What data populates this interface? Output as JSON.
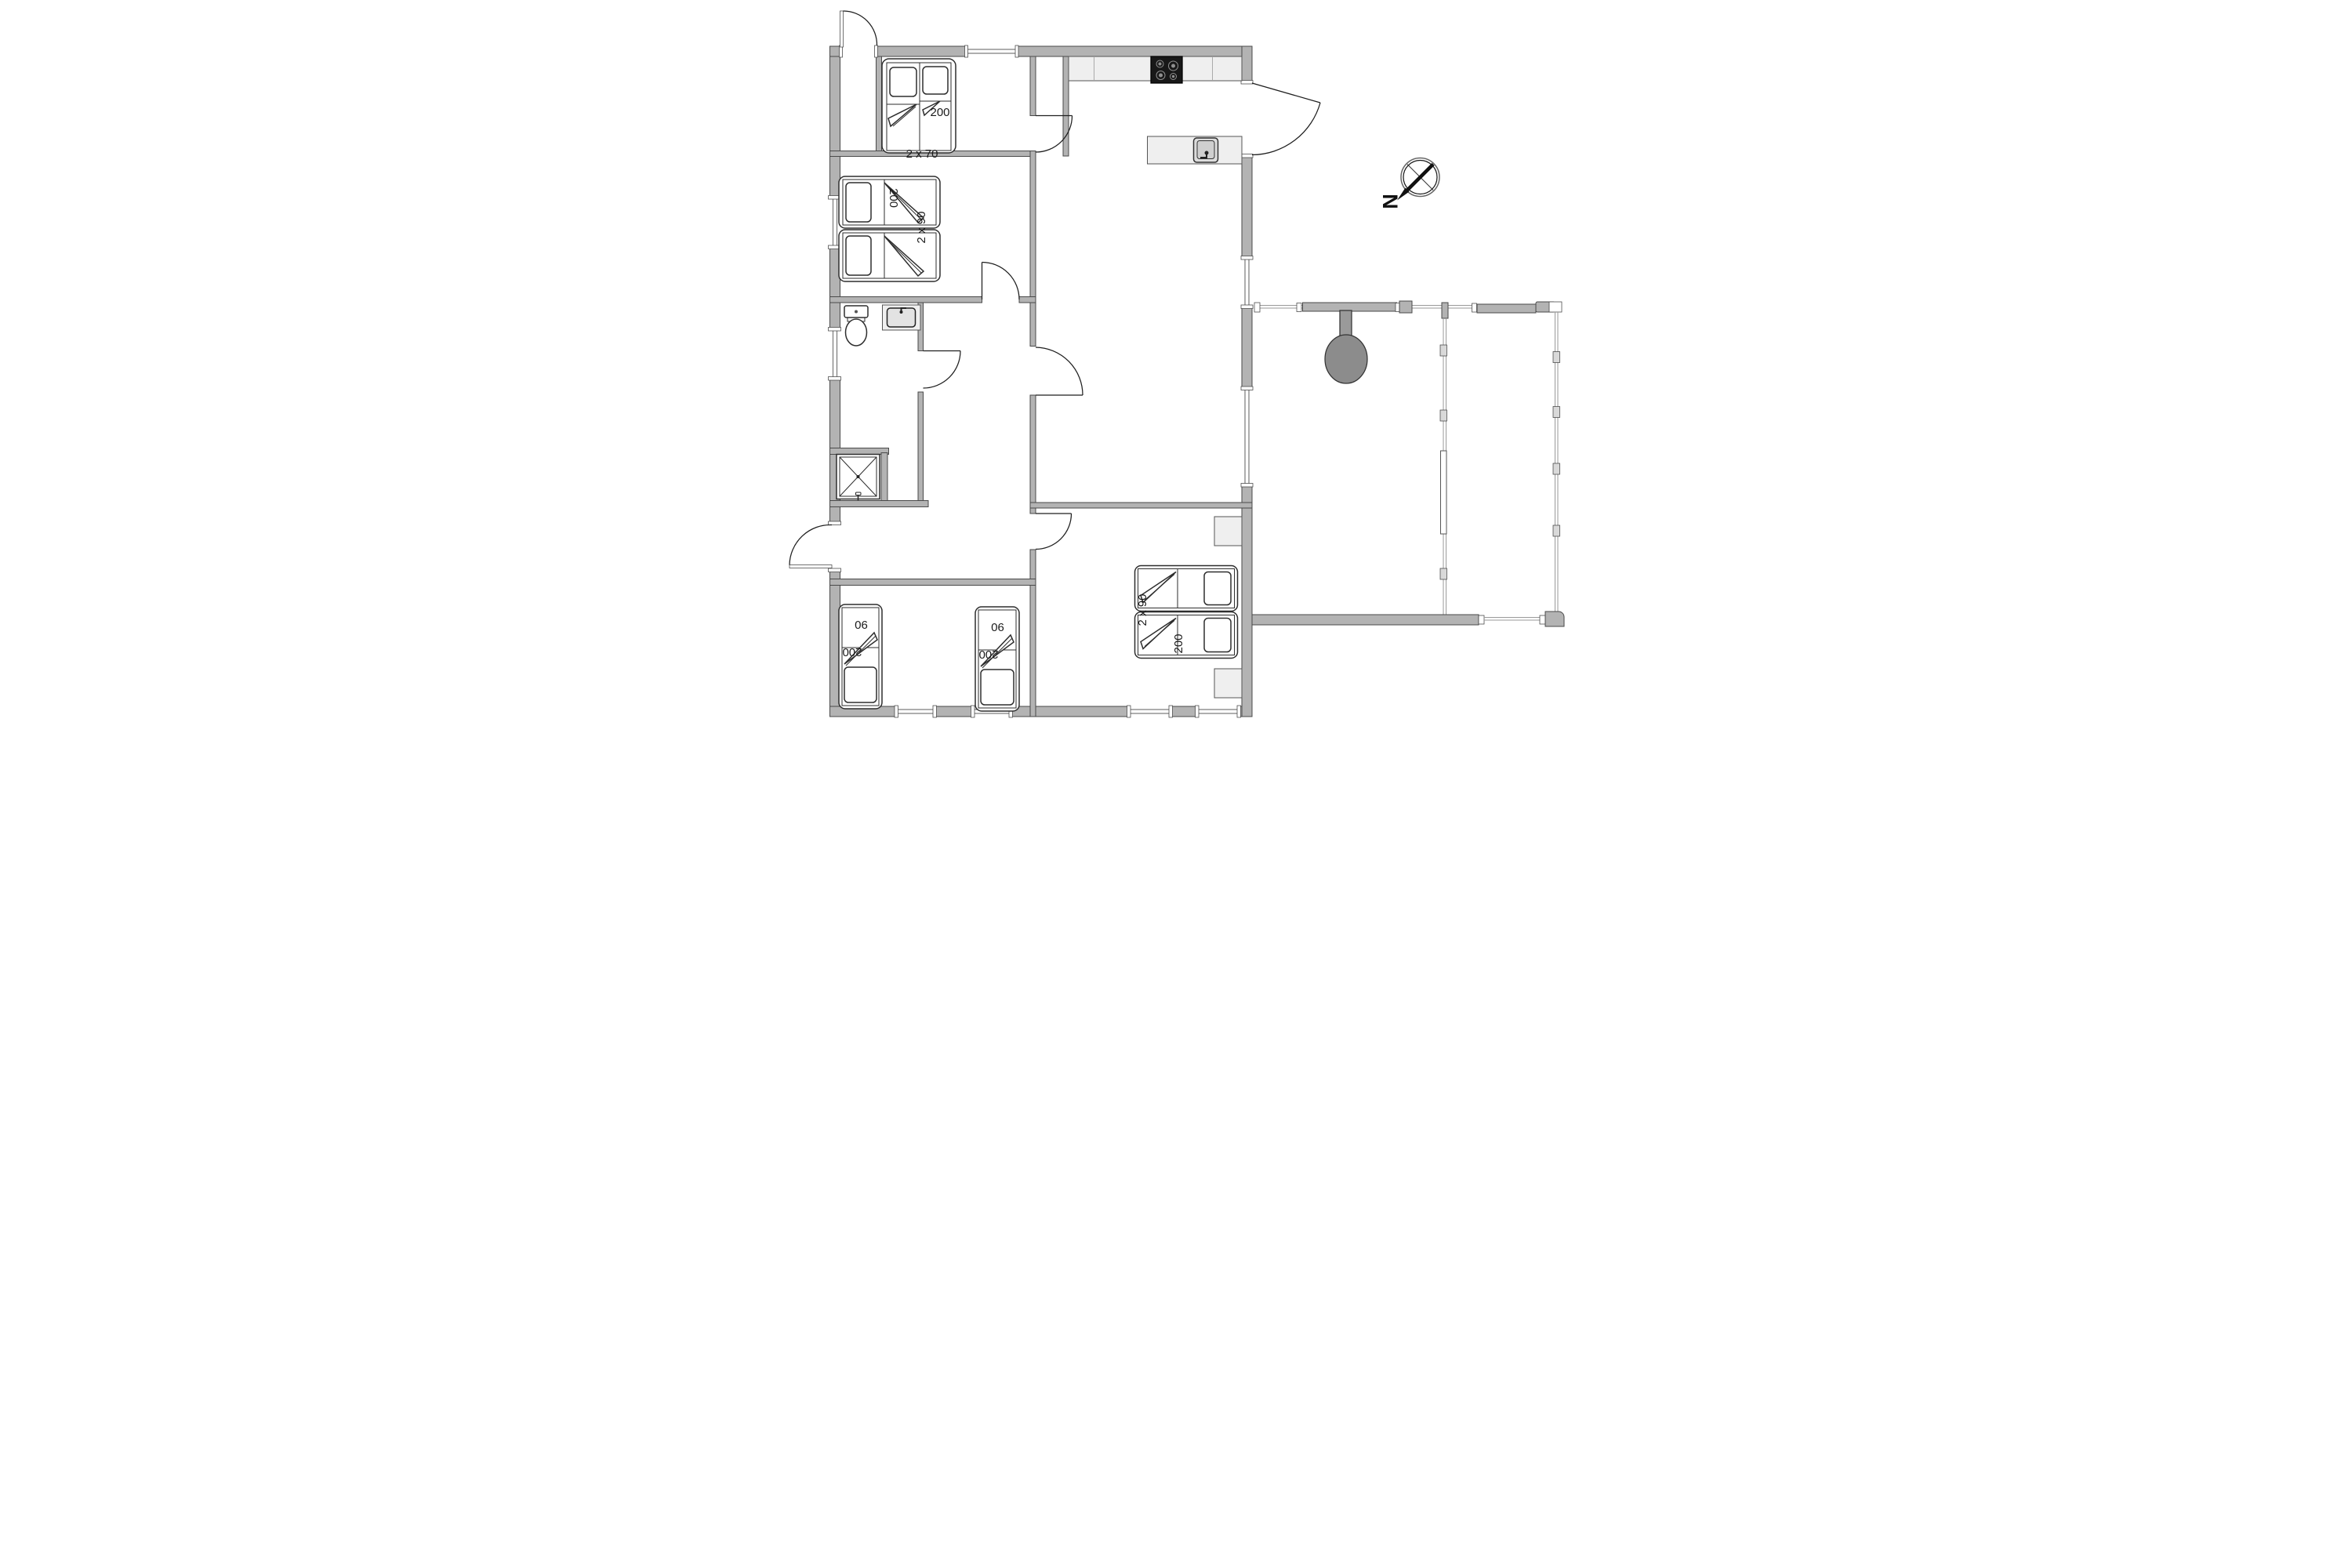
{
  "plan": {
    "kind": "holiday-home-floor-plan"
  },
  "labels": {
    "bedroom_top_left": {
      "bed_length": "200",
      "bed_width": "2 x 70"
    },
    "bedroom_left": {
      "bed_length": "200",
      "bed_width": "2 x 90"
    },
    "bedroom_bottom_left": {
      "bed_a_width": "90",
      "bed_a_length": "200",
      "bed_b_width": "90",
      "bed_b_length": "200"
    },
    "bedroom_bottom_middle": {
      "bed_width": "2 x 90",
      "bed_length": "200"
    },
    "compass": {
      "north": "N"
    }
  },
  "colors": {
    "background": "#ffffff",
    "wall_fill": "#b3b3b3",
    "wall_edge": "#4a4a4a",
    "fixture_fill": "#efefef",
    "outline": "#2e2e2e",
    "cooktop": "#181818",
    "grill": "#8c8c8c",
    "railing": "#9a9a9a"
  }
}
